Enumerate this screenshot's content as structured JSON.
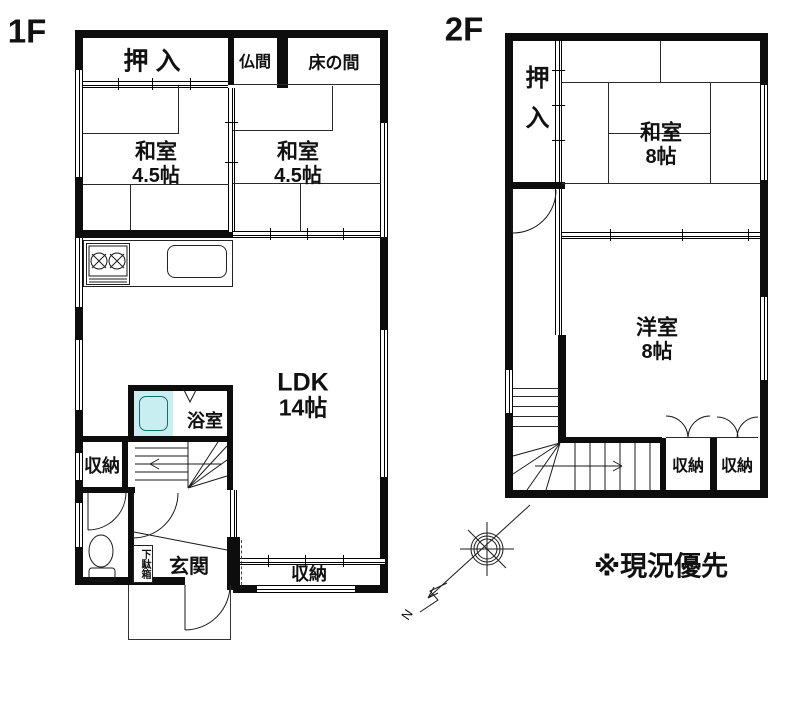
{
  "floor1": {
    "label": "1F",
    "oshiire": "押 入",
    "butsuma": "仏間",
    "tokonoma": "床の間",
    "washitsu_left_name": "和室",
    "washitsu_left_size": "4.5帖",
    "washitsu_right_name": "和室",
    "washitsu_right_size": "4.5帖",
    "ldk_name": "LDK",
    "ldk_size": "14帖",
    "bathroom": "浴室",
    "storage_left": "収納",
    "storage_bottom": "収納",
    "genkan": "玄関",
    "getabako": "下駄箱"
  },
  "floor2": {
    "label": "2F",
    "oshiire": "押入",
    "washitsu_name": "和室",
    "washitsu_size": "8帖",
    "youshitsu_name": "洋室",
    "youshitsu_size": "8帖",
    "storage_1": "収納",
    "storage_2": "収納"
  },
  "compass": {
    "north": "N"
  },
  "note": "※現況優先",
  "colors": {
    "bathtub": "#c9eef2",
    "wall": "#0d0d0d",
    "background": "#ffffff"
  }
}
